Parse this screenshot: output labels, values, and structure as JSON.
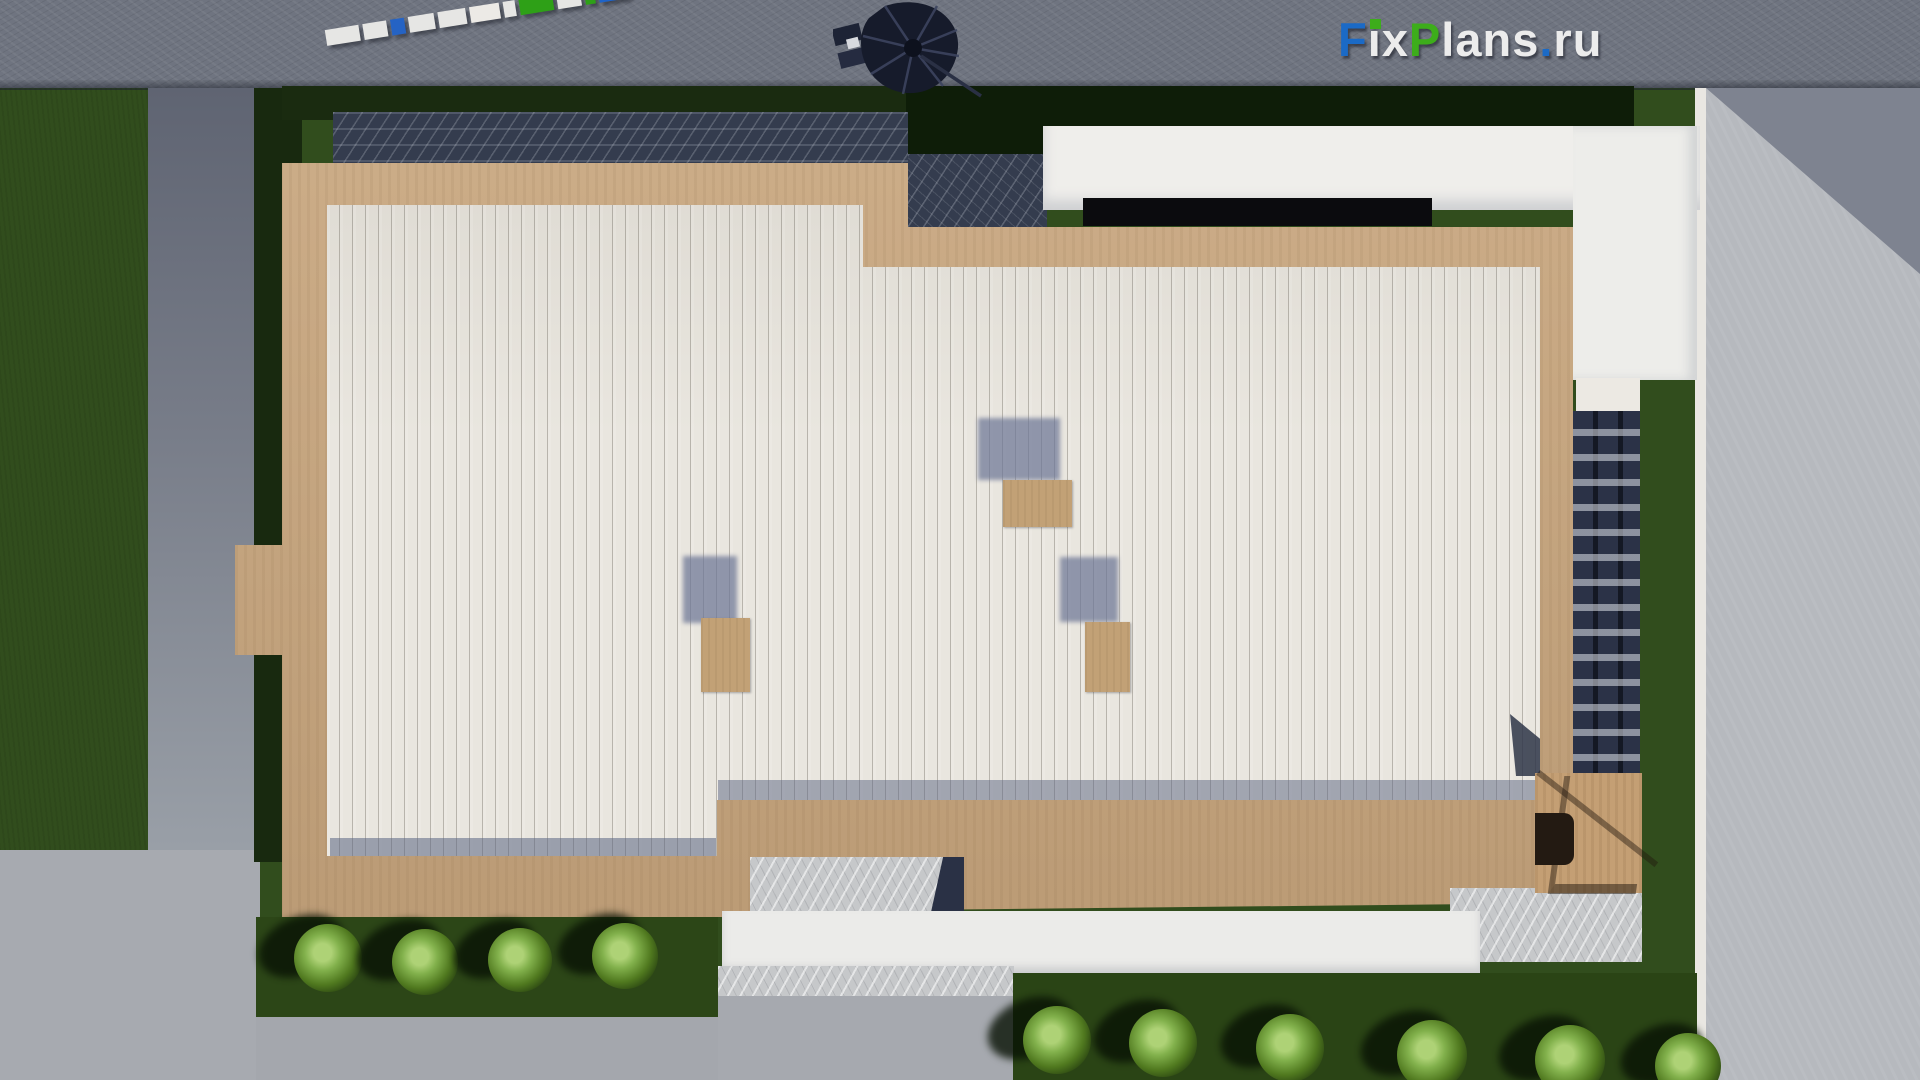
{
  "watermark": {
    "text": "FixPlans.ru",
    "letters": [
      {
        "ch": "F",
        "color": "#1b6ac6"
      },
      {
        "ch": "i",
        "color": "#ececec",
        "dot_color": "#3dad1b"
      },
      {
        "ch": "x",
        "color": "#ececec"
      },
      {
        "ch": "P",
        "color": "#3dad1b"
      },
      {
        "ch": "l",
        "color": "#ececec"
      },
      {
        "ch": "a",
        "color": "#ececec"
      },
      {
        "ch": "n",
        "color": "#ececec"
      },
      {
        "ch": "s",
        "color": "#ececec"
      },
      {
        "ch": ".",
        "color": "#1b6ac6"
      },
      {
        "ch": "r",
        "color": "#ececec"
      },
      {
        "ch": "u",
        "color": "#ececec"
      }
    ]
  },
  "scene": {
    "description": "Top-down 3D render of a flat-roof house: white plank roof with wooden deck border, lawns, paths, roof objects",
    "colors": {
      "road_gray": "#6f7480",
      "deck_wood": "#c7a57d",
      "roof_planks": "#e9e6df",
      "lawn": "#314d1d",
      "hedge_dark": "#0e1d08",
      "slate_paving": "#343c4e",
      "light_marble": "#c6c8ca",
      "driveway": "#b6b9be",
      "parapet_white": "#efeeeb",
      "window_slot": "#0b0b0e",
      "stair_wall": "#2b3247"
    }
  },
  "scale_bar": {
    "segments": [
      {
        "w": 34,
        "c": "#e6e6e4"
      },
      {
        "w": 24,
        "c": "#e6e6e4"
      },
      {
        "w": 14,
        "c": "#2563c4"
      },
      {
        "w": 26,
        "c": "#e6e6e4"
      },
      {
        "w": 28,
        "c": "#e6e6e4"
      },
      {
        "w": 30,
        "c": "#eceae6"
      },
      {
        "w": 12,
        "c": "#e6e6e4"
      },
      {
        "w": 34,
        "c": "#2ea017"
      },
      {
        "w": 24,
        "c": "#e6e6e4"
      },
      {
        "w": 10,
        "c": "#2ea017"
      },
      {
        "w": 30,
        "c": "#1e63c8"
      }
    ]
  },
  "chimneys": [
    {
      "sx": 683,
      "sy": 556,
      "sw": 54,
      "sh": 67,
      "x": 701,
      "y": 618,
      "w": 49,
      "h": 74
    },
    {
      "sx": 978,
      "sy": 418,
      "sw": 82,
      "sh": 62,
      "x": 1003,
      "y": 480,
      "w": 69,
      "h": 47
    },
    {
      "sx": 1060,
      "sy": 557,
      "sw": 58,
      "sh": 65,
      "x": 1085,
      "y": 622,
      "w": 45,
      "h": 70
    }
  ],
  "bushes": {
    "left_row": [
      {
        "x": 328,
        "y": 958,
        "r": 34
      },
      {
        "x": 425,
        "y": 962,
        "r": 33
      },
      {
        "x": 520,
        "y": 960,
        "r": 32
      },
      {
        "x": 625,
        "y": 956,
        "r": 33
      }
    ],
    "right_row": [
      {
        "x": 1057,
        "y": 1040,
        "r": 34
      },
      {
        "x": 1163,
        "y": 1043,
        "r": 34
      },
      {
        "x": 1290,
        "y": 1048,
        "r": 34
      },
      {
        "x": 1432,
        "y": 1055,
        "r": 35
      },
      {
        "x": 1570,
        "y": 1060,
        "r": 35
      },
      {
        "x": 1688,
        "y": 1066,
        "r": 33
      }
    ]
  }
}
